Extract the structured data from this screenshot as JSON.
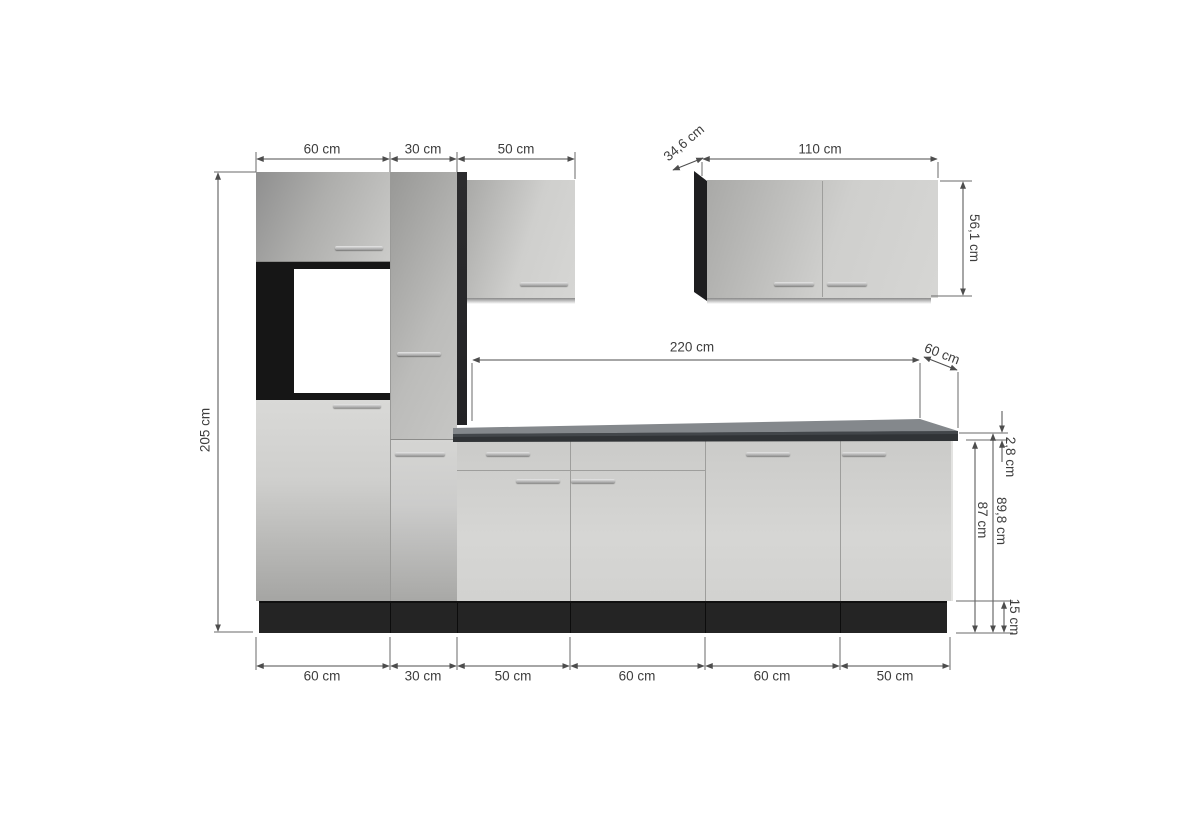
{
  "diagram": {
    "kind": "kitchen-unit-dimension-drawing",
    "units": "cm"
  },
  "labels": {
    "top": {
      "tall_oven_cabinet_width": "60 cm",
      "tall_cabinet_width": "30 cm",
      "wall_cabinet_left_width": "50 cm"
    },
    "wall_cabinet_right": {
      "depth": "34,6 cm",
      "width": "110 cm",
      "height": "56,1 cm"
    },
    "total_height": "205 cm",
    "countertop": {
      "width": "220 cm",
      "depth": "60 cm",
      "thickness": "2,8 cm"
    },
    "heights": {
      "worktop_height_total": "89,8 cm",
      "base_cabinet_height": "87 cm",
      "plinth_height": "15 cm"
    },
    "bottom": [
      "60 cm",
      "30 cm",
      "50 cm",
      "60 cm",
      "60 cm",
      "50 cm"
    ]
  },
  "colors": {
    "background": "#ffffff",
    "cabinet_front_light": "#d2d2d0",
    "cabinet_front_shaded": "#9a9a98",
    "carcass_anthracite": "#242424",
    "countertop_top": "#84888c",
    "countertop_front": "#303336",
    "oven_front": "#ffffff",
    "dimension_line": "#4d4d4d",
    "label_text": "#3d3d3d"
  }
}
